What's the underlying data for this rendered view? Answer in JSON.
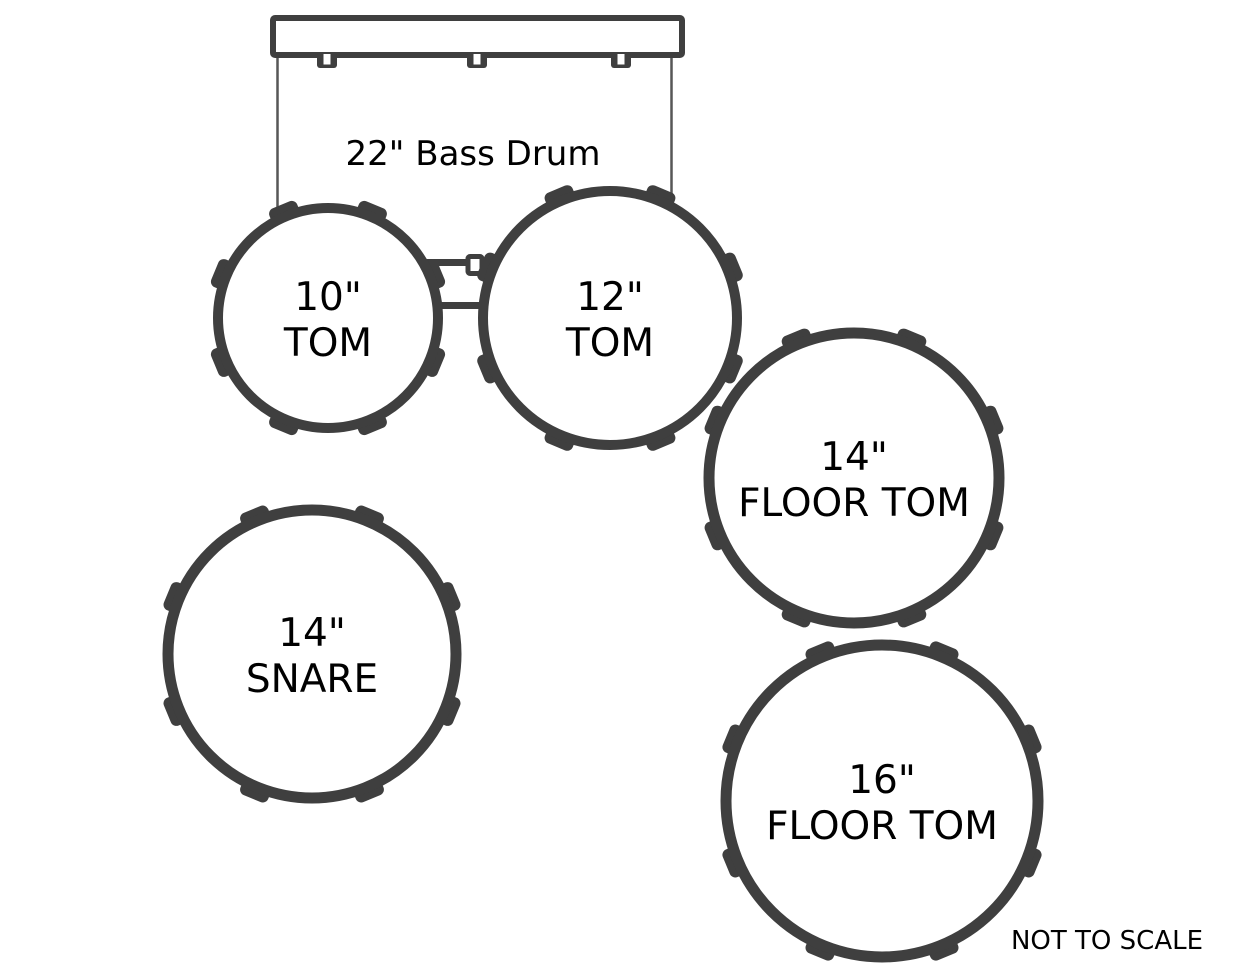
{
  "kit": {
    "bass_drum": {
      "label": "22\" Bass Drum"
    },
    "drums": [
      {
        "size_label": "10\"",
        "name_label": "TOM"
      },
      {
        "size_label": "12\"",
        "name_label": "TOM"
      },
      {
        "size_label": "14\"",
        "name_label": "FLOOR TOM"
      },
      {
        "size_label": "14\"",
        "name_label": "SNARE"
      },
      {
        "size_label": "16\"",
        "name_label": "FLOOR TOM"
      }
    ],
    "footnote": "NOT TO SCALE"
  },
  "colors": {
    "outline": "#3f3f3f",
    "thin_line": "#575757",
    "text": "#000000",
    "background": "#ffffff"
  }
}
